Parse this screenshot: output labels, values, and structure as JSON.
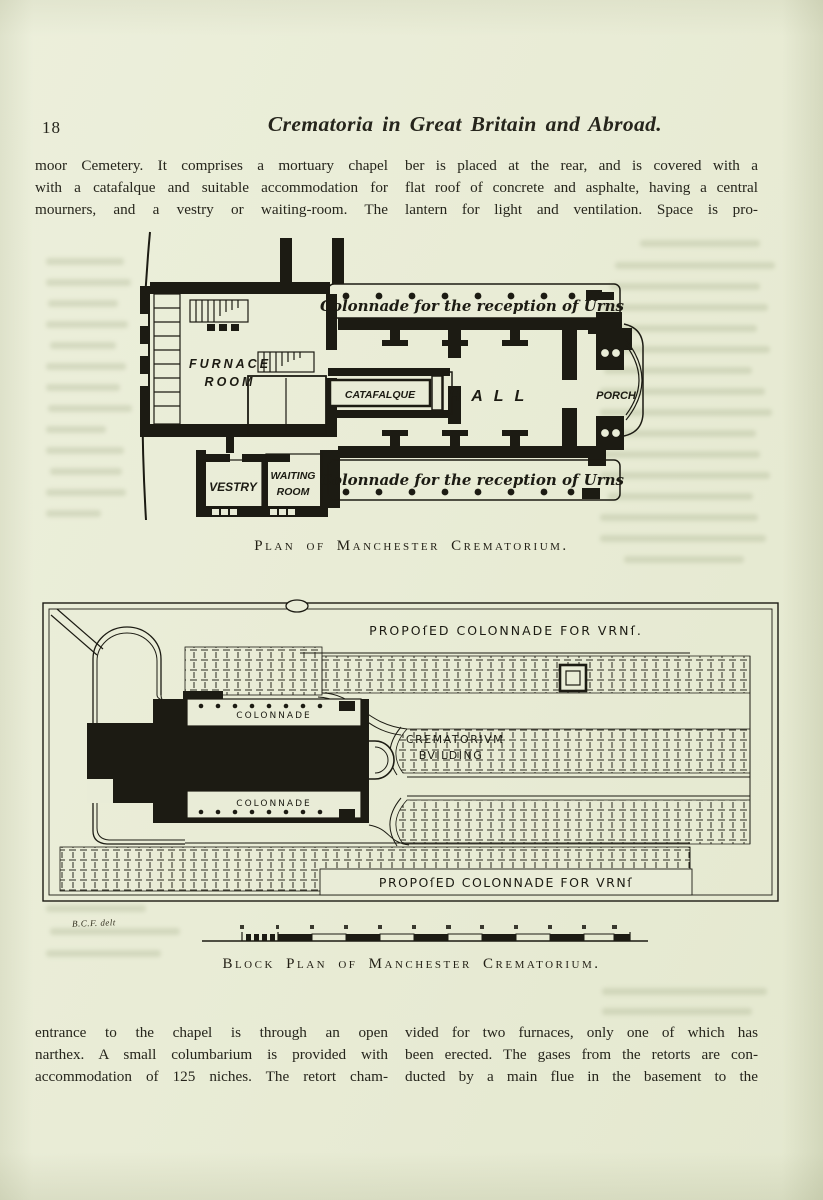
{
  "colors": {
    "paper": "#e9ecd7",
    "ink": "#1c1b13"
  },
  "page": {
    "number": "18",
    "title": "Crematoria in Great Britain and Abroad."
  },
  "text": {
    "top_left": [
      "moor Cemetery.  It comprises a mortuary chapel",
      "with a catafalque and suitable accommodation for",
      "mourners, and a vestry or waiting-room.  The"
    ],
    "top_right": [
      "ber is placed at the rear, and is covered with a",
      "flat roof of concrete and asphalte, having a central",
      "lantern for light and ventilation.  Space is pro-"
    ],
    "bottom_left": [
      "entrance to the chapel is through an open",
      "narthex.  A small columbarium is provided with",
      "accommodation of 125 niches.  The retort cham-"
    ],
    "bottom_right": [
      "vided for two furnaces, only one of which has",
      "been erected.  The gases from the retorts are con-",
      "ducted by a main flue in the basement to the"
    ]
  },
  "figure_plan": {
    "caption": "Plan of Manchester Crematorium.",
    "labels": {
      "colonnade_top": "Colonnade for the reception of Urns",
      "colonnade_bottom": "Colonnade for the reception of Urns",
      "furnace_line1": "FURNACE",
      "furnace_line2": "ROOM",
      "catafalque": "CATAFALQUE",
      "hall": "HALL",
      "porch": "PORCH",
      "vestry": "VESTRY",
      "waiting_line1": "WAITING",
      "waiting_line2": "ROOM"
    }
  },
  "figure_block": {
    "caption": "Block Plan of Manchester Crematorium.",
    "signature": "B.C.F. delt",
    "labels": {
      "top_band": "PROPOſED COLONNADE FOR VRNſ.",
      "bottom_band": "PROPOſED COLONNADE FOR VRNſ",
      "colonnade_top": "COLONNADE",
      "colonnade_bottom": "COLONNADE",
      "building_line1": "CREMATORIVM",
      "building_line2": "BVILDING"
    }
  }
}
